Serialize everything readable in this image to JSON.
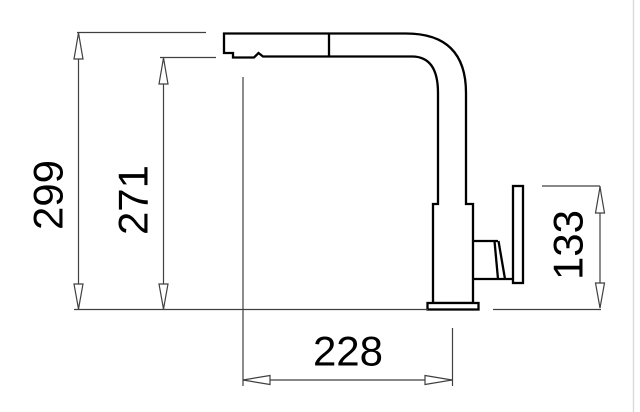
{
  "drawing": {
    "subject": "kitchen-faucet-technical-side-view",
    "dimensions": [
      {
        "name": "total-height",
        "label": "299",
        "orientation": "vertical"
      },
      {
        "name": "spout-outlet-height",
        "label": "271",
        "orientation": "vertical"
      },
      {
        "name": "handle-top-height",
        "label": "133",
        "orientation": "vertical"
      },
      {
        "name": "spout-reach",
        "label": "228",
        "orientation": "horizontal"
      }
    ],
    "colors": {
      "outline": "#000000",
      "dimension_lines": "#404040",
      "background": "#ffffff",
      "frame_edge": "#d9d9d9"
    }
  }
}
